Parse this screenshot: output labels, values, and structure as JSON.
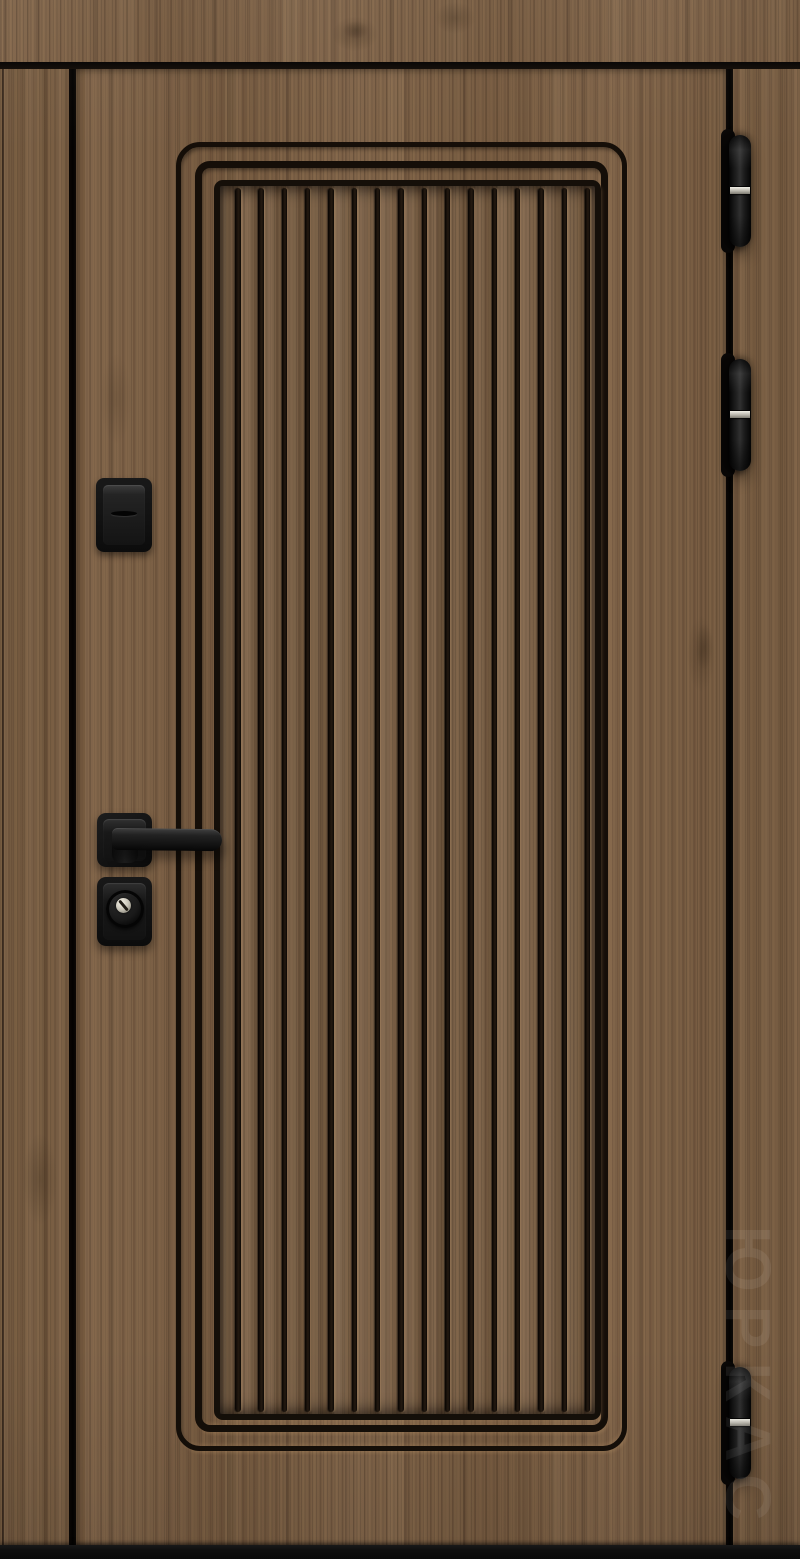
{
  "photo": {
    "subject": "entrance-door-in-frame",
    "colors": {
      "wood_finish": "#7c5f43",
      "wood_grain_dark": "#4d3723",
      "wood_grain_light": "#a6815a",
      "hardware_black": "#171717",
      "hinge_ring_silver": "#c9c5b8",
      "gap_shadow": "#0a0705",
      "threshold_black": "#121212"
    },
    "door": {
      "panel": {
        "slat_count": 16,
        "molding_frames": 3
      },
      "hinges": [
        {
          "position": "top"
        },
        {
          "position": "middle"
        },
        {
          "position": "bottom"
        }
      ],
      "hardware_items": [
        "night-latch",
        "lever-handle",
        "cylinder-lock"
      ]
    },
    "watermark": {
      "text": "ЮРКАС",
      "opacity": 0.075
    }
  }
}
